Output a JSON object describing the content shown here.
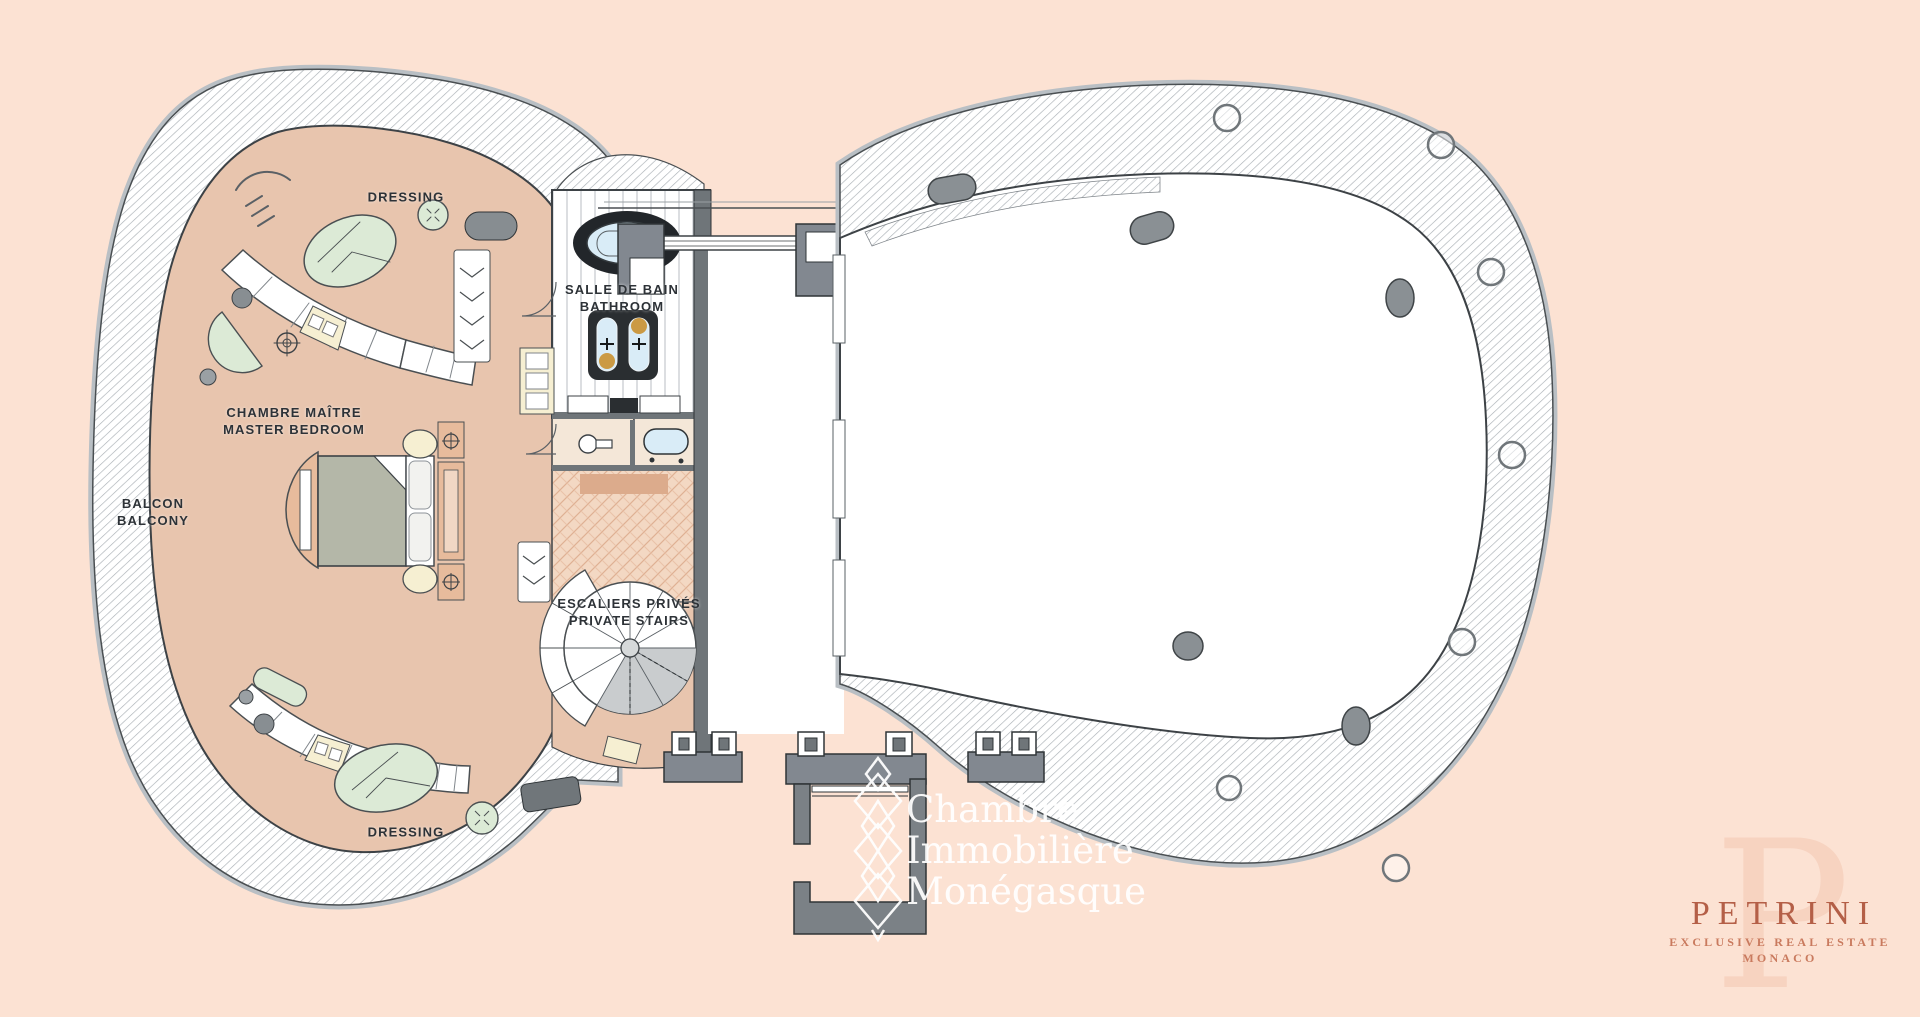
{
  "page": {
    "type": "penthouse floor plan",
    "colors": {
      "background": "#fce2d3",
      "floor_tan": "#e8c5ae",
      "wall_gray": "#828890",
      "line_dark": "#3d4246",
      "furniture_mint": "#dcead6",
      "furniture_cream": "#f6efd2",
      "water_blue": "#d9ecf7",
      "herringbone_wood": "#f3d8c3",
      "label_text": "#2d3237",
      "brand_terracotta": "#b45f47"
    }
  },
  "labels": {
    "dressing_top": "DRESSING",
    "salle_de_bain": "SALLE DE BAIN",
    "bathroom": "BATHROOM",
    "chambre_maitre": "CHAMBRE MAÎTRE",
    "master_bedroom": "MASTER BEDROOM",
    "balcon": "BALCON",
    "balcony": "BALCONY",
    "escaliers_prives": "ESCALIERS PRIVÉS",
    "private_stairs": "PRIVATE STAIRS",
    "dressing_bottom": "DRESSING"
  },
  "watermark": {
    "line1": "Chambre",
    "line2": "Immobilière",
    "line3": "Monégasque"
  },
  "brand": {
    "monogram": "P",
    "name": "PETRINI",
    "tagline": "EXCLUSIVE REAL ESTATE MONACO"
  }
}
